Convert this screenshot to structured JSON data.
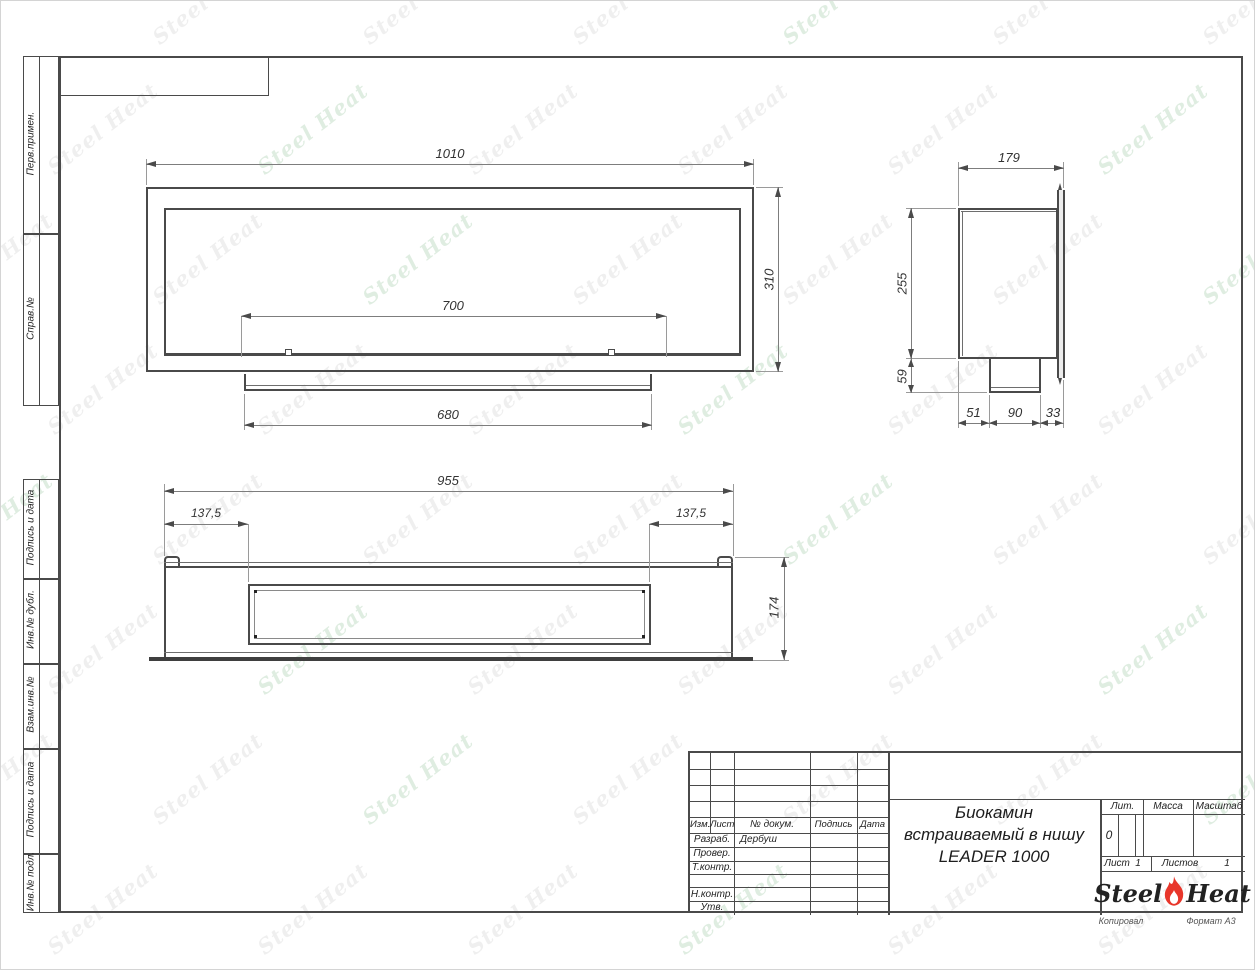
{
  "watermark": {
    "text": "Steel Heat",
    "gray": "rgba(155,155,155,0.16)",
    "green": "rgba(110,175,120,0.22)"
  },
  "sidebar": {
    "top": [
      {
        "label": "Перв.примен."
      },
      {
        "label": "Справ.№"
      }
    ],
    "bottom": [
      {
        "label": "Подпись и дата"
      },
      {
        "label": "Инв.№ дубл."
      },
      {
        "label": "Взам.инв.№"
      },
      {
        "label": "Подпись и дата"
      },
      {
        "label": "Инв.№ подл."
      }
    ]
  },
  "views": {
    "front": {
      "width": "1010",
      "height": "310",
      "opening_width": "700",
      "tray_width": "680"
    },
    "side": {
      "depth": "179",
      "height": "255",
      "tray_height": "59",
      "seg1": "51",
      "seg2": "90",
      "seg3": "33"
    },
    "top": {
      "width": "955",
      "left_offset": "137,5",
      "right_offset": "137,5",
      "depth": "174"
    }
  },
  "title_block": {
    "revision_header": {
      "izm": "Изм.",
      "list": "Лист",
      "doc": "№ докум.",
      "sign": "Подпись",
      "date": "Дата"
    },
    "staff_rows": [
      {
        "label": "Разраб.",
        "value": "Дербуш"
      },
      {
        "label": "Провер.",
        "value": ""
      },
      {
        "label": "Т.контр.",
        "value": ""
      },
      {
        "label": "Н.контр.",
        "value": ""
      },
      {
        "label": "Утв.",
        "value": ""
      }
    ],
    "title_lines": [
      "Биокамин",
      "встраиваемый в нишу",
      "LEADER 1000"
    ],
    "lit_header": "Лит.",
    "mass_header": "Масса",
    "scale_header": "Масштаб",
    "lit_value": "0",
    "sheet_label": "Лист",
    "sheet_value": "1",
    "sheets_label": "Листов",
    "sheets_value": "1",
    "logo": {
      "word1": "Steel",
      "word2": "Heat",
      "flame_color": "#e8362b"
    },
    "below": {
      "copied": "Копировал",
      "format": "Формат А3"
    }
  }
}
